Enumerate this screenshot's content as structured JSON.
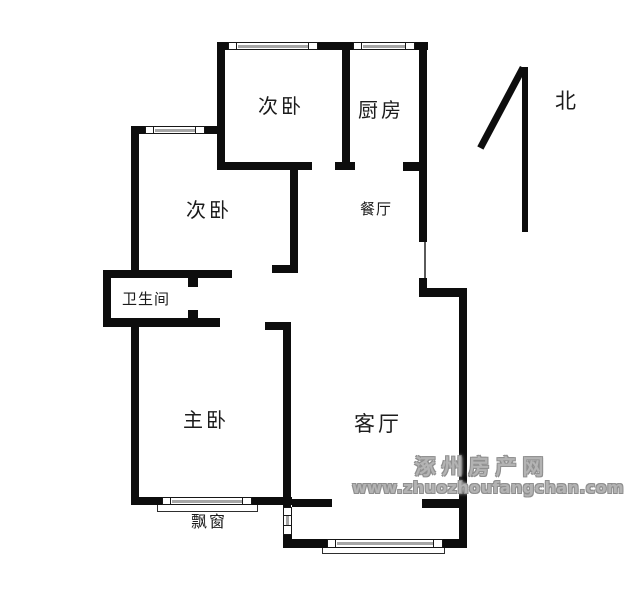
{
  "rooms": {
    "bedroom_top": {
      "label": "次卧"
    },
    "bedroom_left": {
      "label": "次卧"
    },
    "kitchen": {
      "label": "厨房"
    },
    "dining": {
      "label": "餐厅"
    },
    "bathroom": {
      "label": "卫生间"
    },
    "master_bedroom": {
      "label": "主卧"
    },
    "living_room": {
      "label": "客厅"
    },
    "bay_window": {
      "label": "飘窗"
    }
  },
  "compass": {
    "north_label": "北"
  },
  "watermark": {
    "site_name": "涿州房产网",
    "site_url": "www.zhuozhoufangchan.com"
  },
  "colors": {
    "wall": "#0d0d0d",
    "window_glass": "#a6a6a6",
    "watermark_gray": "#b3b3b3",
    "label_text": "#1c1c1c",
    "background": "#ffffff"
  }
}
